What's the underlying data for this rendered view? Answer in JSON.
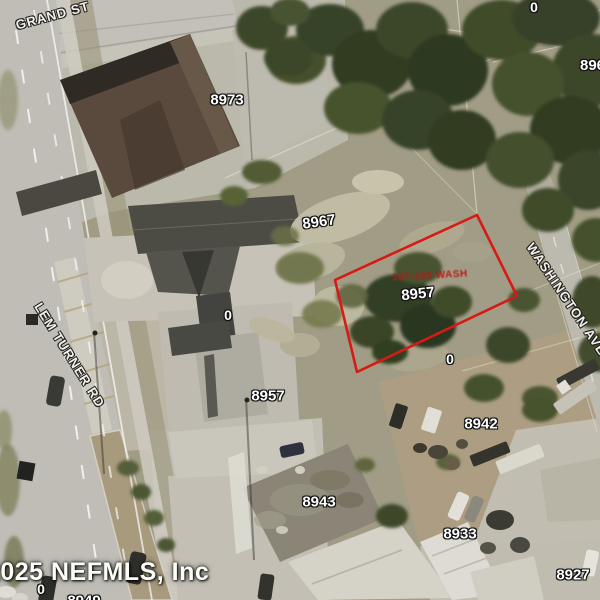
{
  "map": {
    "watermark": "©2025 NEFMLS, Inc",
    "streets": {
      "grand_st": "GRAND ST",
      "lem_turner_rd": "LEM TURNER RD",
      "washington_ave": "WASHINGTON AVE"
    },
    "parcel_labels": {
      "p8973": "8973",
      "p8967": "8967",
      "p8961": "8961",
      "p8957_south": "8957",
      "p8942": "8942",
      "p8943": "8943",
      "p8933": "8933",
      "p8927": "8927",
      "p8949": "8949",
      "lot0_north": "0",
      "lot0_center": "0",
      "lot0_subject": "0",
      "lot0_southwest": "0"
    },
    "subject_parcel": {
      "number": "8957",
      "annotation": "107-100 WASH",
      "outline_color": "#dd1a15"
    }
  }
}
